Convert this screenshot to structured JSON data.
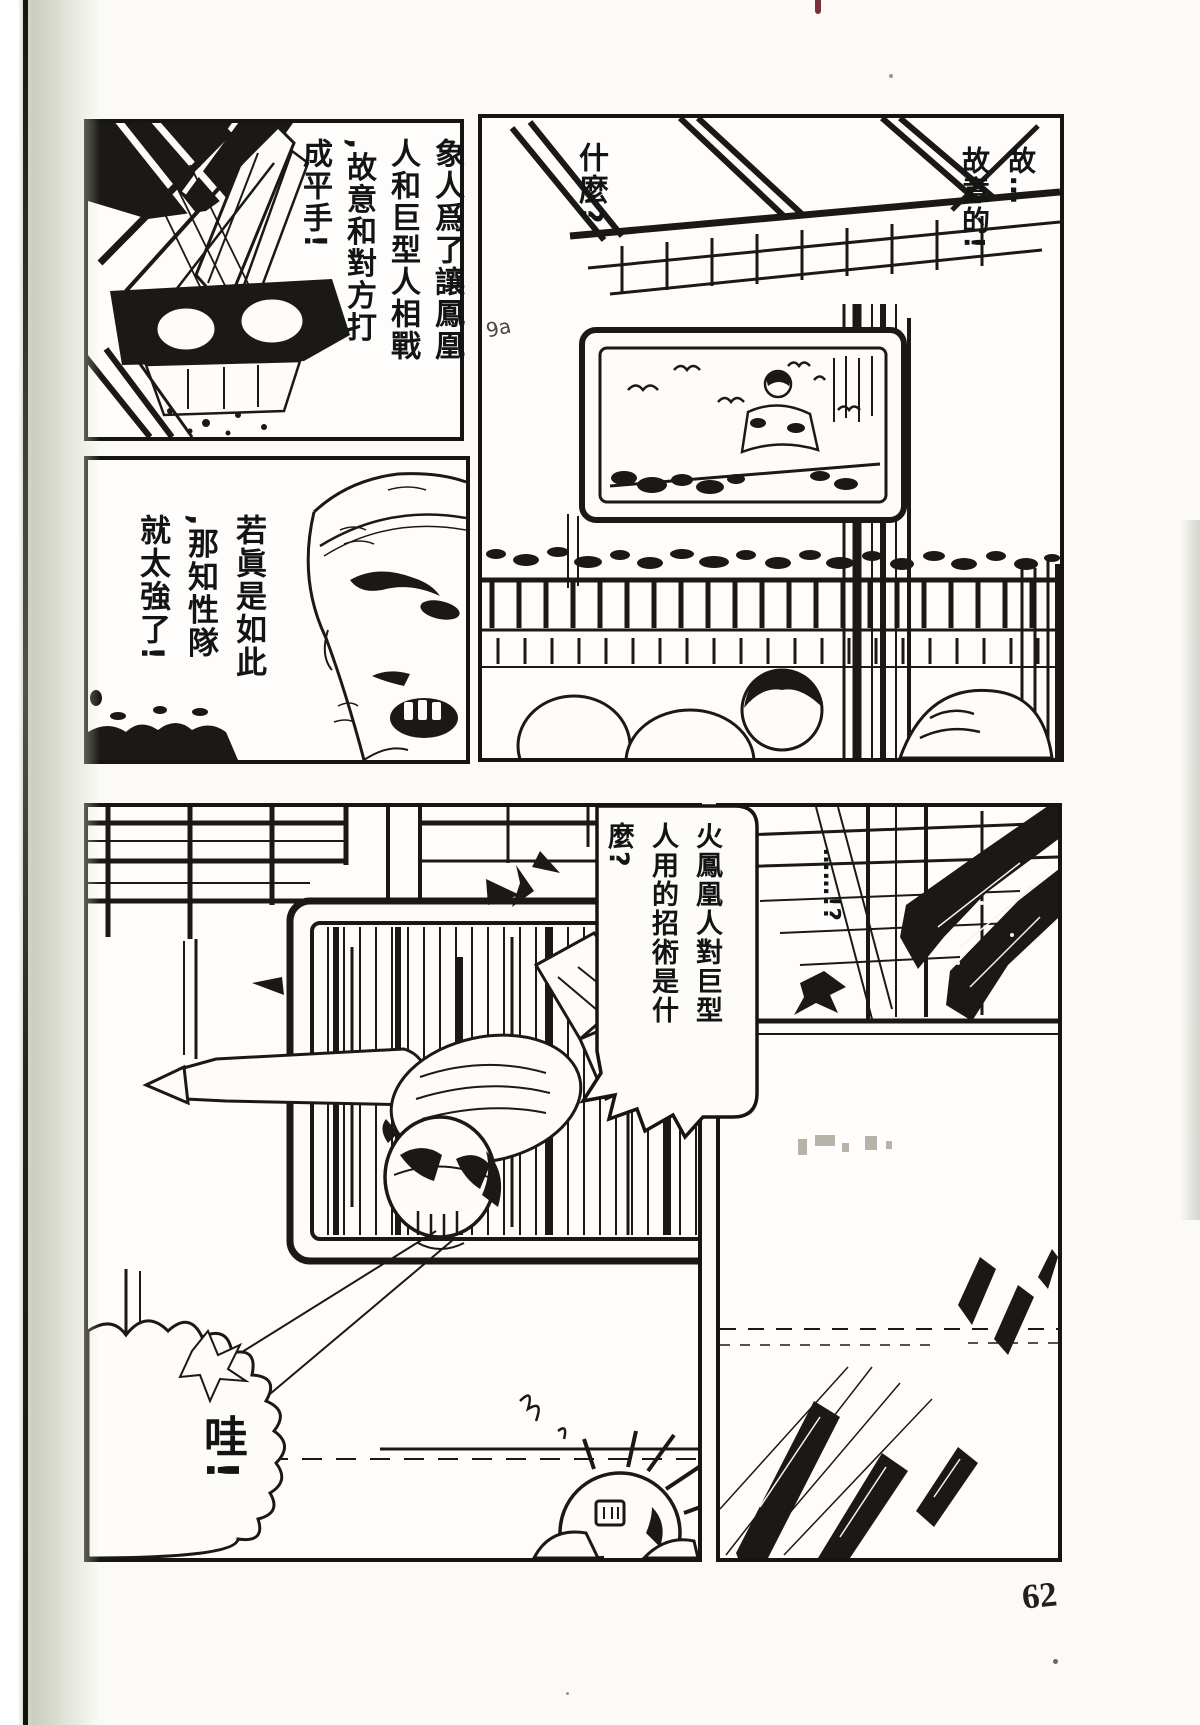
{
  "page_number": "62",
  "pencil_scribble": "9a",
  "dialogues": {
    "deliberate": "故…\n故意的!",
    "what": "什麼?",
    "elephant_plan": "象人爲了讓鳳凰\n人和巨型人相戰\n,故意和對方打\n成平手!",
    "if_true": "若眞是如此\n,那知性隊\n就太強了!",
    "phoenix_question": "火鳳凰人對巨型\n人用的招術是什\n麼?",
    "shock": "……!?",
    "wah": "哇!"
  }
}
